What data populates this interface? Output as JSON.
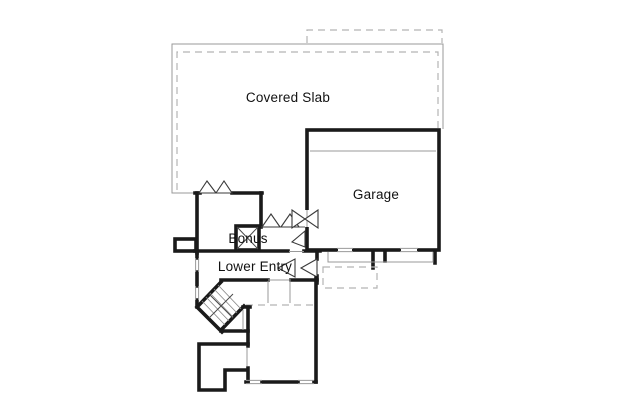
{
  "plan": {
    "labels": {
      "covered_slab": "Covered Slab",
      "garage": "Garage",
      "bonus": "Bonus",
      "lower_entry": "Lower Entry"
    },
    "colors": {
      "background": "#ffffff",
      "wall": "#1a1a1a",
      "thin_line": "#999999",
      "dashed_line": "#b3b3b3",
      "text": "#111111"
    }
  }
}
